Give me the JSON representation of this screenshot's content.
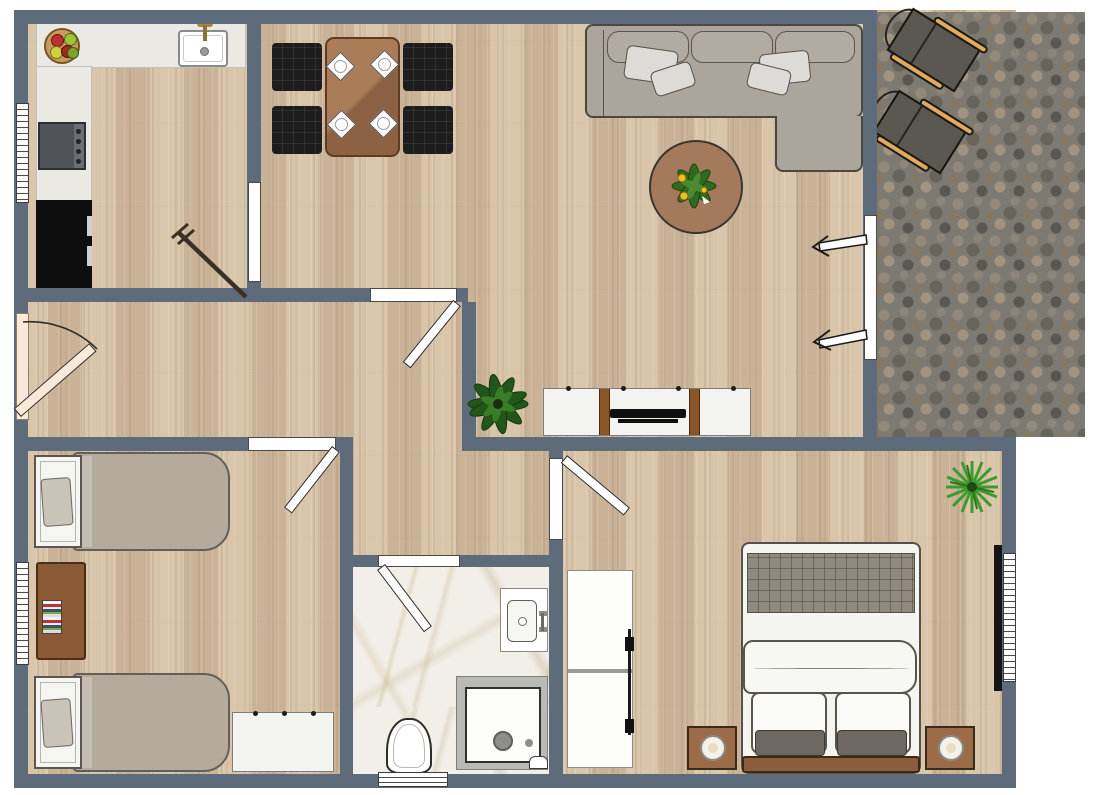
{
  "app": {
    "type": "floor-plan",
    "title": "apartment-floor-plan",
    "visible_text": "none"
  },
  "colors": {
    "wall": "#5d6b7b",
    "wood": "#d3bfa4",
    "stone": "#7d7a71",
    "marble": "#f2efe8",
    "counter": "#eae9e4",
    "doorCream": "#f8e9d9",
    "chairBlack": "#1d1d1d",
    "tableBrown": "#9c6b4d",
    "rugBrown": "#a5795c",
    "sofaGray": "#aca59b",
    "blanket": "#b4ab9c",
    "tan": "#e3aa5e",
    "plantGreen": "#2f6b1f",
    "plantBright": "#3f9a2e",
    "nightstandBrown": "#9c6c48",
    "benchBrown": "#8a5e3c",
    "applianceBlack": "#0e0e0e",
    "stoveGray": "#505358"
  },
  "rooms": [
    {
      "name": "kitchen",
      "floor": "wood-with-counters"
    },
    {
      "name": "dining-living-room",
      "floor": "wood"
    },
    {
      "name": "patio",
      "floor": "stone"
    },
    {
      "name": "hallway",
      "floor": "wood"
    },
    {
      "name": "kids-bedroom",
      "floor": "wood"
    },
    {
      "name": "bathroom",
      "floor": "marble"
    },
    {
      "name": "master-bedroom",
      "floor": "wood"
    }
  ],
  "furniture": {
    "kitchen": [
      "fruit-bowl",
      "sink",
      "faucet",
      "stove",
      "black-counter",
      "broom"
    ],
    "dining": [
      "dining-table",
      "chair x4",
      "plate x4"
    ],
    "living": [
      "sectional-sofa",
      "pillows x4",
      "round-rug",
      "potted-plant",
      "tv-sideboard",
      "tv",
      "floor-plant"
    ],
    "patio": [
      "lounge-chair x2"
    ],
    "kids-bedroom": [
      "single-bed x2",
      "desk",
      "books",
      "dresser"
    ],
    "bathroom": [
      "toilet",
      "shower",
      "vanity-sink"
    ],
    "master-bedroom": [
      "double-bed",
      "tufted-headboard",
      "nightstand x2",
      "lamp x2",
      "foot-bench",
      "wardrobe-white",
      "wardrobe-black-rail",
      "palm-plant"
    ]
  },
  "openings": {
    "windows": [
      "kitchen-window-left",
      "kids-bedroom-window-left",
      "master-bedroom-window-right",
      "bathroom-window-bottom"
    ],
    "doors": [
      "entrance-door-cream",
      "kitchen-door-closed",
      "hall-living-door",
      "kids-bedroom-door",
      "bathroom-door",
      "master-bedroom-door",
      "patio-slider-with-arrows"
    ]
  }
}
